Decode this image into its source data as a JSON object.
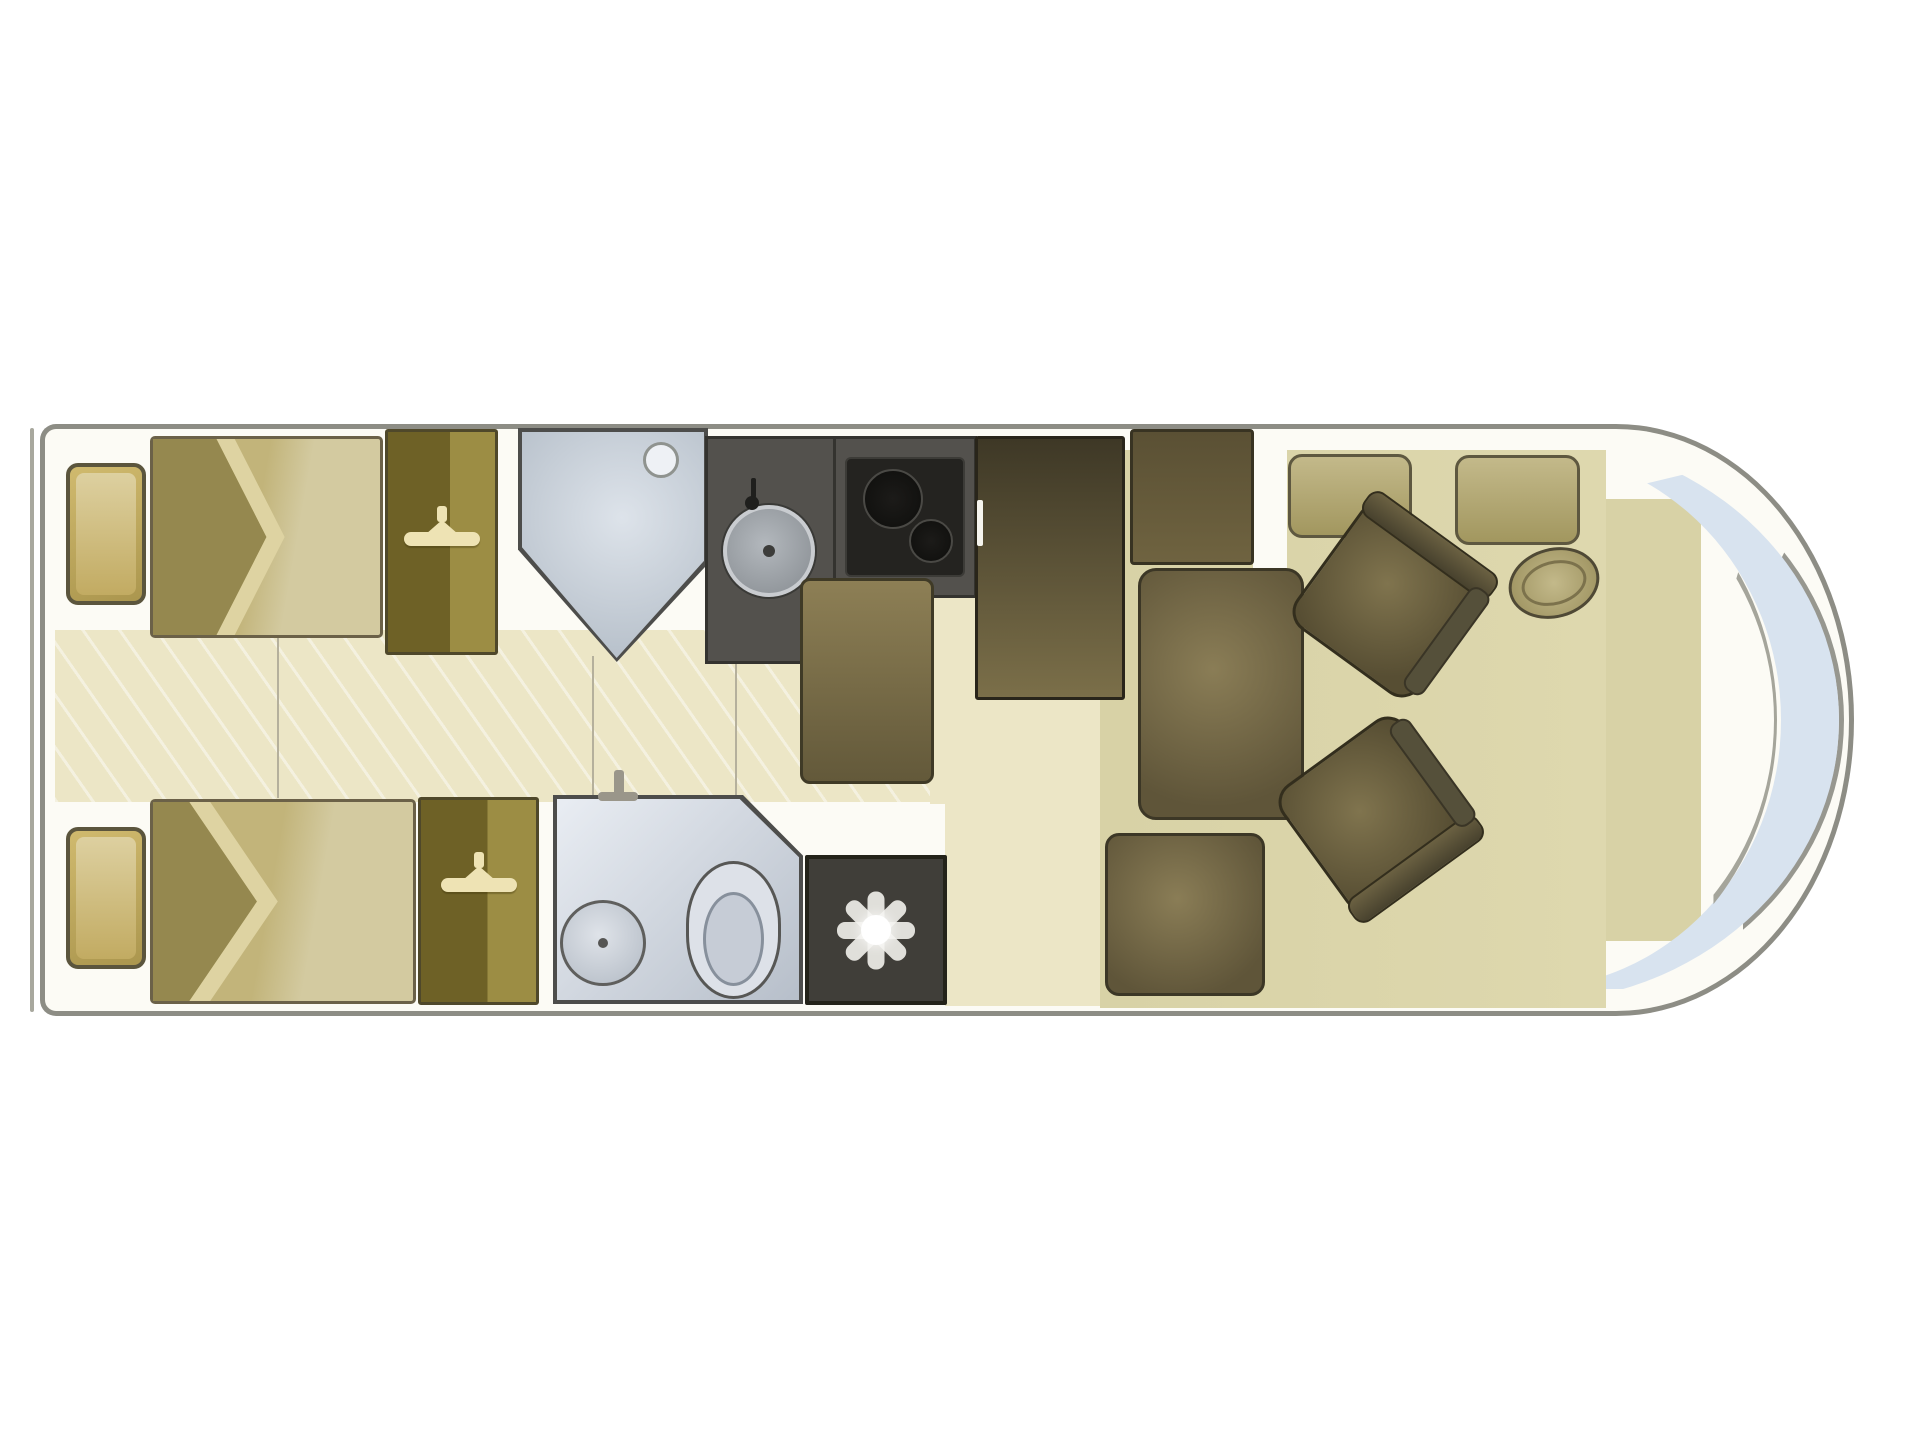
{
  "page": {
    "title": "Motorhome floor plan (top view)"
  },
  "diagram": {
    "type": "motorhome-floorplan-top-view",
    "front_direction": "right",
    "zones": {
      "rear_bedroom": "Rear bedroom with two single beds, bedside cabinets and wardrobes",
      "washroom": "Washroom with basin and toilet, separate shower cubicle opposite",
      "kitchen": "Kitchen with sink, two-burner hob, lower unit and tall fridge",
      "lounge": "Mid lounge with sideboard and sofa seats",
      "cab": "Front cab with two swivel seats, steering wheel and panoramic windscreen"
    },
    "labels": {
      "vehicle": "Motorhome body (front to the right)",
      "windscreen": "Panoramic windscreen",
      "dashboard": "Dashboard area",
      "bed_top": "Single bed (left side)",
      "bed_bottom": "Single bed (right side)",
      "bed_fold": "Turned-down bedding",
      "nightstand": "Bedside cabinet",
      "wardrobe": "Wardrobe",
      "hanger": "Clothes hanger",
      "shower": "Shower cubicle",
      "shower_head": "Shower head",
      "worktop": "Kitchen worktop",
      "sink": "Kitchen sink",
      "faucet": "Sink tap",
      "hob": "Two-burner hob",
      "burner": "Hob burner",
      "fridge": "Fridge / tall cabinet",
      "fridge_handle": "Fridge handle",
      "kitchen_unit": "Kitchen lower unit",
      "sideboard": "Sideboard / TV unit",
      "lounge_seat": "Lounge sofa seat",
      "side_seat": "Side bench seat",
      "locker": "Front locker",
      "steering_wheel": "Steering wheel",
      "driver_seat": "Swivel cab seat (driver)",
      "passenger_seat": "Swivel cab seat (passenger)",
      "seat_backrest": "Seat backrest",
      "seat_armrest": "Seat armrest",
      "washroom": "Washroom",
      "basin": "Washbasin",
      "toilet": "Toilet",
      "tap": "Washroom tap",
      "heater": "Heater / vent panel",
      "star": "Vent star",
      "aisle": "Centre aisle floor",
      "corridor": "Kitchen corridor floor",
      "entry": "Entrance floor",
      "lounge_floor": "Lounge floor",
      "door_line": "Door / partition line",
      "bumper": "Rear bumper line"
    },
    "colors": {
      "hull": "#8d8d85",
      "body_fill": "#fcfbf5",
      "floor_cream": "#ece6c6",
      "floor_olive": "#d8d2a6",
      "bed": "#c9bc83",
      "bed_fold_dark": "#95884f",
      "bed_fold_light": "#ded3a2",
      "nightstand": "#c3ad62",
      "wardrobe_dark": "#6e6126",
      "wardrobe_light": "#9c8d44",
      "hanger": "#eee3b4",
      "shower_fill": "#b9c2cc",
      "shower_light": "#dde3ea",
      "counter": "#53514d",
      "stove": "#242320",
      "fridge_dark": "#3e3826",
      "fridge_light": "#7b6f49",
      "seat_dark": "#5f5539",
      "seat_light": "#8a7d56",
      "seat_border": "#3c3726",
      "locker_light": "#c3b98a",
      "locker_dark": "#a2975f",
      "bath_light": "#e9edf3",
      "bath_dark": "#b7bfca",
      "outline_dark": "#4d4d4b",
      "panel_dark": "#403e39",
      "star_white": "#f2f1ec",
      "windshield": "#d8e3ef",
      "line": "#b5b09c"
    }
  }
}
